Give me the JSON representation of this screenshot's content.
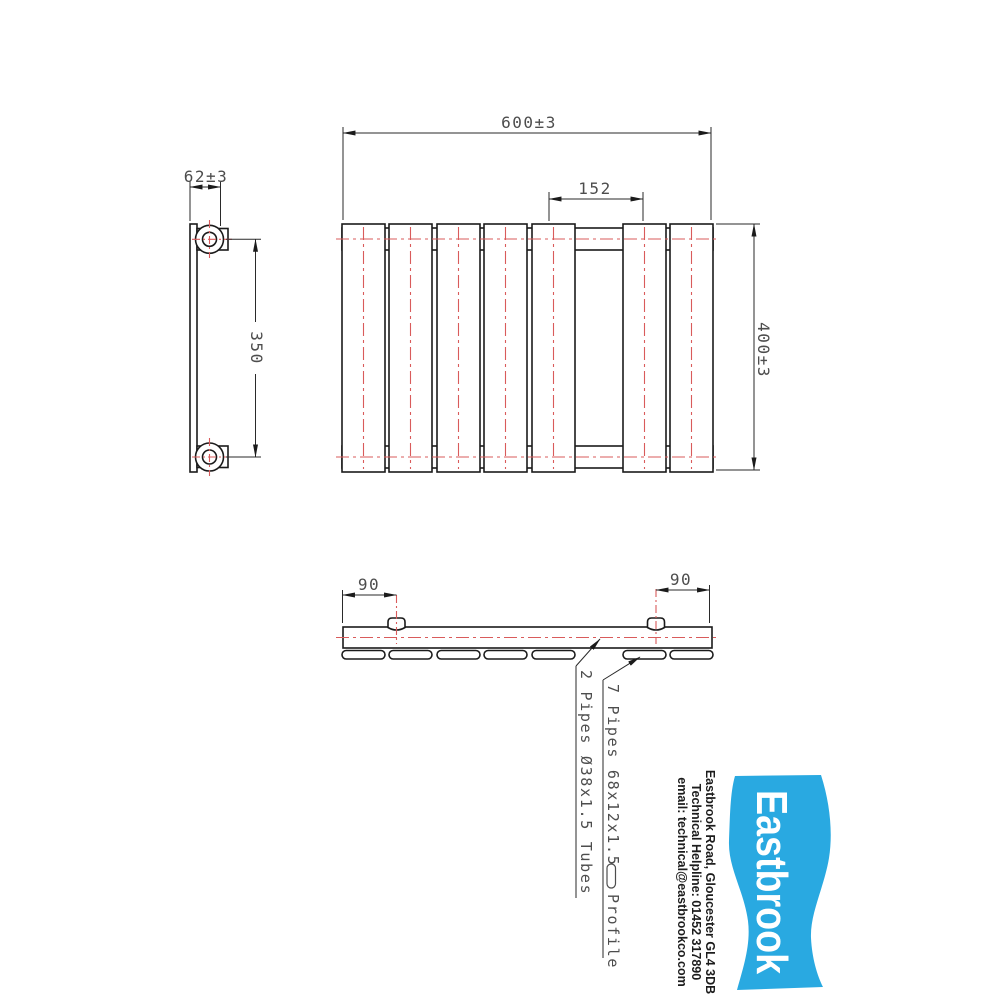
{
  "dimensions": {
    "overall_width": "600±3",
    "tapping_centres": "152",
    "overall_height": "400±3",
    "depth": "62±3",
    "bracket_centres": "350",
    "connection_offset_left": "90",
    "connection_offset_right": "90"
  },
  "annotations": {
    "tubes": "2 Pipes Ø38x1.5 Tubes",
    "profile": "7 Pipes 68x12x1.5",
    "profile_suffix": "Profile"
  },
  "logo": {
    "brand": "Eastbrook",
    "address": "Eastbrook Road, Gloucester GL4 3DB",
    "helpline": "Technical Helpline: 01452 317890",
    "email": "email: technical@eastbrookco.com",
    "brand_color": "#29A9E1"
  },
  "colors": {
    "outline": "#1b1b1b",
    "centerline": "#d95b5b",
    "dimension_text": "#4d4d4d",
    "background": "#ffffff"
  }
}
